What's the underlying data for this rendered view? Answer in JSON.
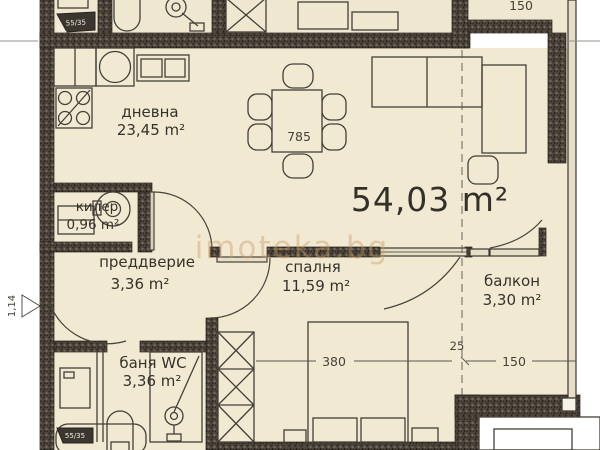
{
  "watermark": "imoteka.bg",
  "total_area": "54,03 m²",
  "rooms": {
    "living": {
      "name": "дневна",
      "area": "23,45 m²"
    },
    "closet": {
      "name": "килер",
      "area": "0,96 m²"
    },
    "vestibule": {
      "name": "преддверие",
      "area": "3,36 m²"
    },
    "bedroom": {
      "name": "спалня",
      "area": "11,59 m²"
    },
    "balcony": {
      "name": "балкон",
      "area": "3,30 m²"
    },
    "bathroom": {
      "name": "баня WC",
      "area": "3,36 m²"
    }
  },
  "dimensions": {
    "dining": "785",
    "bed_width": "380",
    "balcony_width": "150",
    "balcony_wall": "25",
    "neighbor_balcony": "150",
    "shaft_top": "55/35",
    "shaft_bottom": "55/35",
    "level": "1,14"
  }
}
